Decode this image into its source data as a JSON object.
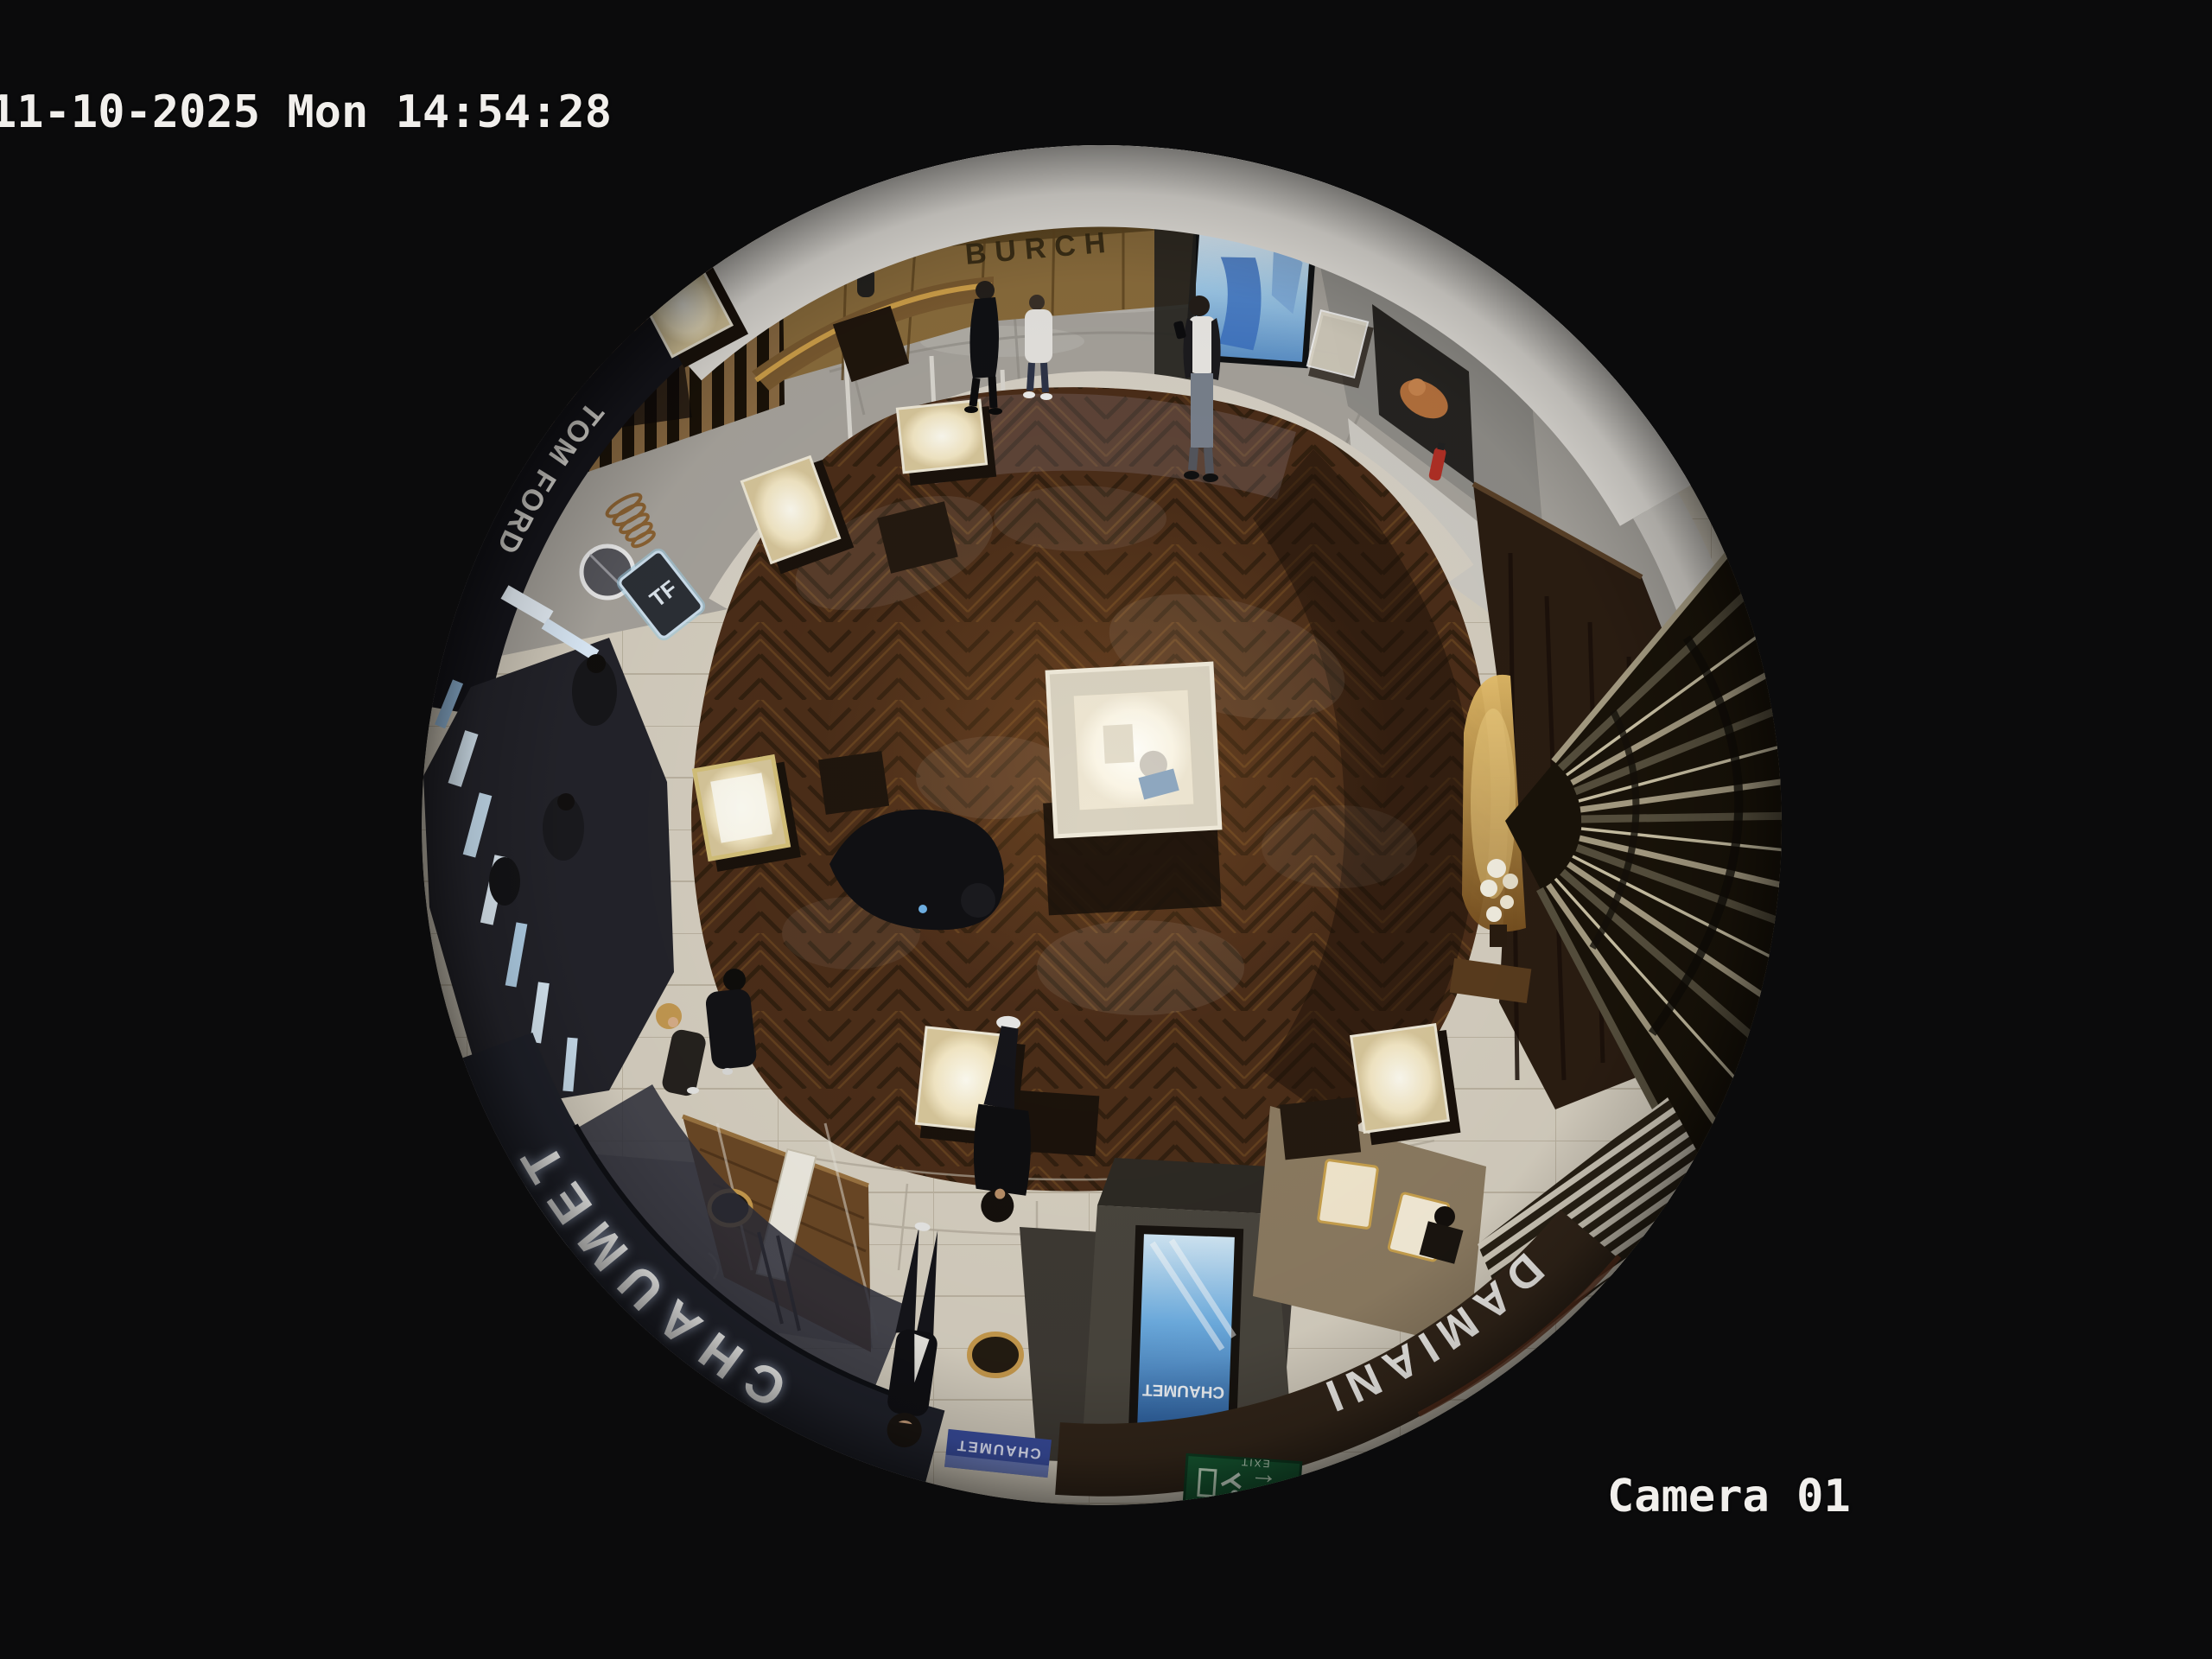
{
  "osd": {
    "timestamp": "11-10-2025 Mon 14:54:28",
    "camera_label": "Camera 01",
    "text_color": "#f1efec"
  },
  "scene": {
    "description": "Overhead 360-degree fisheye CCTV view of a luxury jewelry boutique inside a mall",
    "signs": {
      "chaumet_fascia": "CHAUMET",
      "damiani_fascia": "DAMIANI",
      "tom_ford_fascia": "TOM FORD",
      "tf_monogram": "TF",
      "mall_wall_sign": "BURCH",
      "kiosk_screen_brand": "CHAUMET",
      "damiani_plaque": "DAMIANI",
      "chaumet_plaque": "CHAUMET",
      "exit_sign": "EXIT"
    },
    "icons": {
      "exit_arrow_left": "←"
    },
    "colors": {
      "background": "#0a0a0b",
      "wood_floor": "#4a2d17",
      "tile_floor": "#d7d0c1",
      "mall_marble": "#b2aea7",
      "storefront_band": "#e9e6e0",
      "chaumet_fascia": "#20222b",
      "damiani_fascia": "#33261a",
      "sign_letters": "#ffffff",
      "gold_wall": "#8a6c3c",
      "media_screen_blue": "#9ec9e8",
      "kiosk_screen_blue": "#6fb0e4",
      "exit_green": "#175c34",
      "accent_gold": "#c89b4e"
    }
  }
}
